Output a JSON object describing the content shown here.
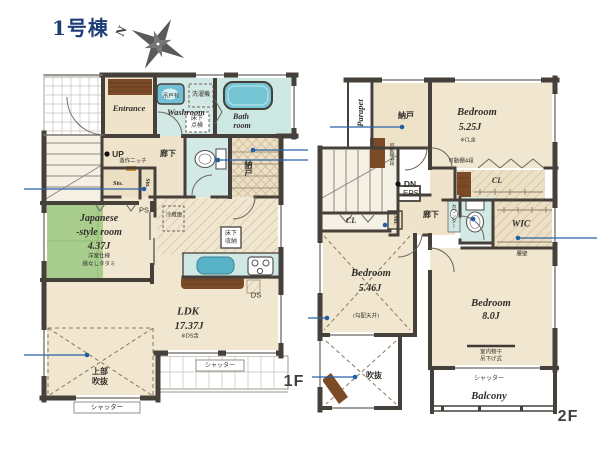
{
  "title": "1号棟",
  "compass": {
    "north": "N"
  },
  "colors": {
    "wall": "#46403a",
    "floor_beige": "#f1e6cf",
    "tatami_green": "#a9cd8d",
    "wet_blue": "#d3e9e5",
    "water": "#74c4d4",
    "wood": "#7b4b28",
    "callout_blue": "#2a62a8",
    "title_navy": "#1d3e78"
  },
  "icons": [
    "compass-rose",
    "bathtub",
    "washbasin",
    "toilet",
    "kitchen-sink",
    "stove",
    "stairs"
  ],
  "f1": {
    "tag": "1F",
    "entrance": "Entrance",
    "washroom": "Washroom",
    "hang_cabinet": "吊戸有",
    "washer": "洗濯機",
    "underfloor_check1": "床下",
    "underfloor_check2": "点検",
    "bath1": "Bath",
    "bath2": "room",
    "hallway": "廊下",
    "storeroom": "納戸",
    "up": "UP",
    "niche": "造作ニッチ",
    "sto_a": "Sto.",
    "sto_b": "Sto.",
    "ps": "PS",
    "jp1": "Japanese",
    "jp2": "-style room",
    "jp_size": "4.37J",
    "jp_note1": "洋室仕様",
    "jp_note2": "縁なしタタミ",
    "fridge": "冷蔵庫",
    "underfloor_storage1": "床下",
    "underfloor_storage2": "収納",
    "ldk": "LDK",
    "ldk_size": "17.37J",
    "ldk_note": "※DS含",
    "ds": "DS",
    "void1": "上部",
    "void2": "吹抜",
    "shutter_deck": "シャッター",
    "shutter_window": "シャッター"
  },
  "f2": {
    "tag": "2F",
    "parapet": "Parapet",
    "storeroom": "納戸",
    "bedroom1": "Bedroom",
    "bedroom1_size": "5.25J",
    "bedroom1_note": "※CL含",
    "shelf_a": "可動棚4段",
    "shelf_b": "可動棚4段",
    "cl_a": "CL",
    "cl_b": "CL",
    "dn": "DN",
    "eps": "EPS",
    "hallway": "廊下",
    "counter": "カウンター",
    "sto": "Sto.",
    "wic": "WIC",
    "waist_wall": "腰壁",
    "bedroom2": "Bedroom",
    "bedroom2_size": "5.46J",
    "bedroom2_note": "(勾配天井)",
    "bedroom3": "Bedroom",
    "bedroom3_size": "8.0J",
    "void": "吹抜",
    "drying1": "室内物干",
    "drying2": "吊下げ式",
    "shutter": "シャッター",
    "balcony": "Balcony"
  }
}
